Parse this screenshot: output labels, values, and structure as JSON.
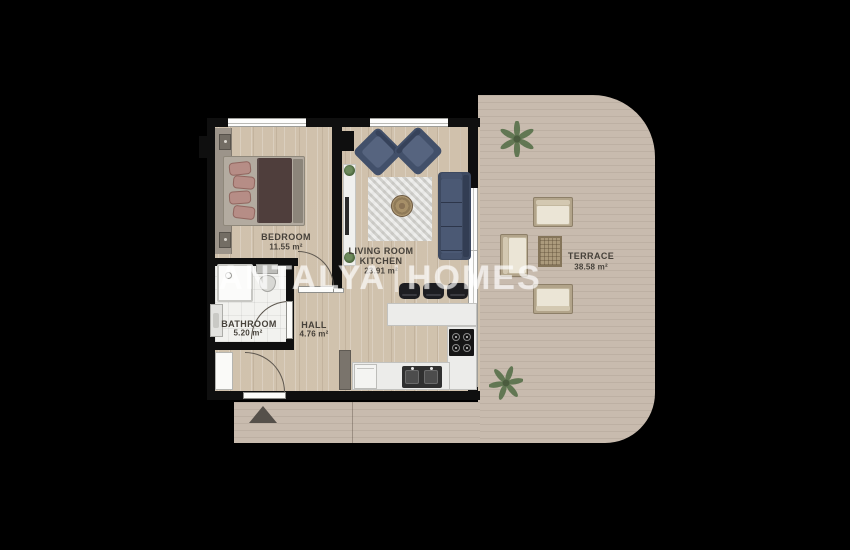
{
  "watermark": {
    "brand_left": "ANTALYA",
    "brand_right": "HOMES"
  },
  "rooms": {
    "bedroom": {
      "name": "BEDROOM",
      "area": "11.55 m²"
    },
    "living": {
      "name": "LIVING ROOM",
      "name2": "KITCHEN",
      "area": "23.91 m²"
    },
    "bathroom": {
      "name": "BATHROOM",
      "area": "5.20 m²"
    },
    "hall": {
      "name": "HALL",
      "area": "4.76 m²"
    },
    "terrace": {
      "name": "TERRACE",
      "area": "38.58 m²"
    }
  },
  "colors": {
    "background": "#000000",
    "wall": "#0f0f0f",
    "wood_floor": "#d5c7b3",
    "terrace_deck": "#c8bbae",
    "bath_tile": "#f2f2ef",
    "sofa_navy": "#3d4960",
    "bed_duvet": "#4f3e3c",
    "pillow_rose": "#b68d86",
    "label_text": "#46413a",
    "watermark": "rgba(255,255,255,0.52)"
  }
}
